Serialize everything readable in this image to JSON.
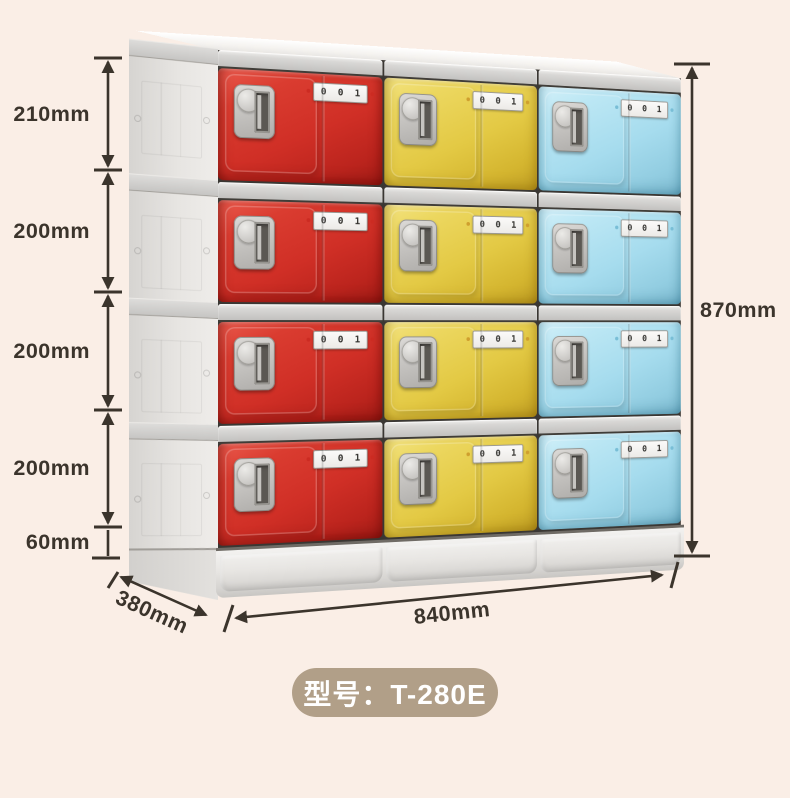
{
  "colors": {
    "background": "#faeee6",
    "red": "#d02f26",
    "yellow": "#e3c944",
    "blue": "#a6dcee",
    "badge": "#b19f88",
    "dimension": "#3b342c"
  },
  "dimensions": {
    "left_heights": [
      "210mm",
      "200mm",
      "200mm",
      "200mm",
      "60mm"
    ],
    "total_height": "870mm",
    "depth": "380mm",
    "width": "840mm"
  },
  "locker": {
    "rows": 4,
    "columns": 3,
    "column_colors": [
      "red",
      "yellow",
      "blue"
    ],
    "door_label": "0 0 1"
  },
  "badge": {
    "text": "型号：T-280E"
  }
}
